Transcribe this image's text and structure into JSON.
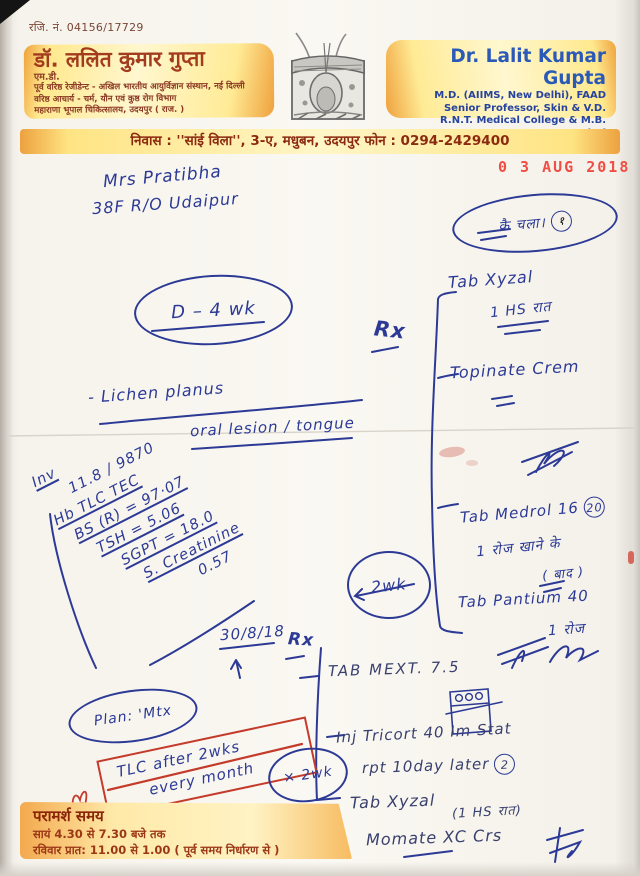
{
  "document": {
    "reg_no": "रजि. नं. 04156/17729",
    "date_stamp": "0 3 AUG 2018",
    "letterhead": {
      "left": {
        "name": "डॉ. ललित कुमार गुप्ता",
        "degree": "एम.डी.",
        "lines": [
          "पूर्व वरिष्ठ रेजीडेन्ट - अखिल भारतीय आयुर्विज्ञान संस्थान, नई दिल्ली",
          "वरिष्ठ आचार्य - चर्म, यौन एवं कुष्ठ रोग विभाग",
          "महाराणा भूपाल चिकित्सालय, उदयपुर ( राज. )"
        ]
      },
      "right": {
        "name": "Dr. Lalit Kumar Gupta",
        "lines": [
          "M.D. (AIIMS, New Delhi), FAAD",
          "Senior Professor, Skin & V.D.",
          "R.N.T. Medical College & M.B. Hospital",
          "UDAIPUR (Raj.)"
        ]
      },
      "logo": "skin-cross-section-illustration"
    },
    "address_bar": "निवास : ''सांई विला'', 3-ए, मधुबन, उदयपुर   फोन : 0294-2429400",
    "footer": {
      "title": "परामर्श समय",
      "lines": [
        "सायं 4.30 से 7.30 बजे तक",
        "रविवार प्रात: 11.00 से 1.00 ( पूर्व समय निर्धारण से )"
      ]
    }
  },
  "hw": {
    "patient_name": "Mrs Pratibha",
    "patient_details": "38F R/O Udaipur",
    "ref_circle": "कै चला।",
    "ref_circle_num": "१",
    "duration": "D – 4 wk",
    "rx1": "Rx",
    "rx1_items": {
      "xyzal": "Tab   Xyzal",
      "xyzal_dose": "1 HS रात",
      "cream": "Topinate Crem"
    },
    "diagnosis": "-  Lichen planus",
    "diagnosis2": "oral lesion / tongue",
    "labs": [
      "Inv",
      "11.8 ∕ 9870",
      "Hb  TLC  TEC",
      "BS (R) = 97·07",
      "TSH = 5.06",
      "SGPT = 18.0",
      "S. Creatinine",
      "0.57"
    ],
    "medrol": "Tab Medrol 16",
    "medrol_qty": "20",
    "medrol_dose": "1 रोज खाने के",
    "medrol_dose2": "( बाद )",
    "review": "2wk",
    "pantium": "Tab Pantium 40",
    "pantium_dose": "1 रोज",
    "next_date": "30/8/18",
    "arrow_up": "↑",
    "rx2": "Rx",
    "mtx": "TAB MEXT. 7.5",
    "plan": "Plan: 'Mtx",
    "monitor1": "TLC after 2wks",
    "monitor2": "every month",
    "review2": "× 2wk",
    "inj": "Inj   Tricort 40 Im Stat",
    "inj2": "rpt 10day later",
    "inj2_num": "2",
    "xyzal2": "Tab Xyzal",
    "xyzal2_dose": "(1 HS रात)",
    "momate": "Momate  XC  Crs"
  },
  "colors": {
    "band_orange": "#f0a23c",
    "band_yellow": "#fff6c8",
    "maroon_text": "#8c2c12",
    "print_blue": "#2b59b8",
    "ink_blue": "#2c3a96",
    "stamp_red": "#f0453c",
    "marker_red": "#c43b2c"
  }
}
